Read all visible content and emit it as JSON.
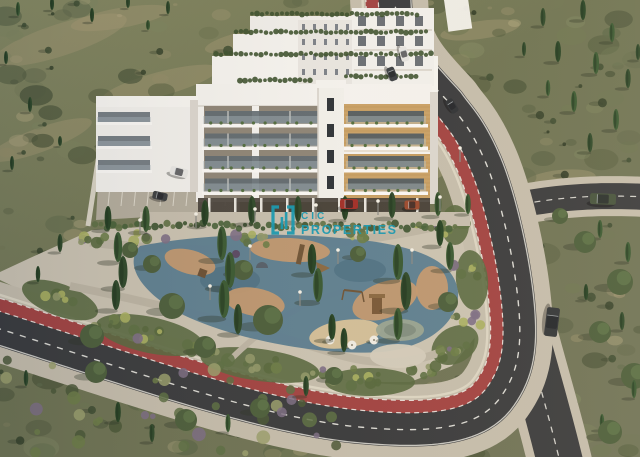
{
  "watermark": {
    "brand": "CIC",
    "brand_suffix": "PROPERTIES",
    "color": "#1d9ab0"
  },
  "scene": {
    "colors": {
      "hill_base": "#6e7454",
      "hill_dark": "#4c563a",
      "hill_light": "#868a64",
      "dry_patch": "#ab9f79",
      "asphalt": "#3a3c3f",
      "bike_lane_red": "#a24444",
      "road_line_white": "#ecebe5",
      "sidewalk": "#c5beae",
      "curb": "#ded8c8",
      "park_ground": "#cbc4b4",
      "path_gray": "#bdb6a6",
      "playground_blue": "#5b7e92",
      "playground_blue_dark": "#4e7084",
      "playground_tan": "#c59a70",
      "sand": "#d8c29a",
      "building_white": "#f5f4f1",
      "building_shade": "#dcd8d1",
      "panel_gray": "#8e8679",
      "panel_wood": "#caa268",
      "wood_line": "#b08a52",
      "glass": "#5e6a72",
      "garage_dark": "#443f39",
      "cypress": "#2f4a2c",
      "olive": "#4c5f3d",
      "shrub_green": "#5d7045",
      "lavender": "#7d6f86",
      "equipment_wood": "#6f5539"
    },
    "cars": [
      {
        "name": "white-van-upper-road",
        "x": 404,
        "y": 54,
        "len": 15,
        "wid": 8,
        "rot": 75,
        "body": "#e6e6e4"
      },
      {
        "name": "dark-suv-upper-road",
        "x": 392,
        "y": 74,
        "len": 14,
        "wid": 8,
        "rot": 68,
        "body": "#3a3f44"
      },
      {
        "name": "dark-car-right-road",
        "x": 452,
        "y": 106,
        "len": 15,
        "wid": 8,
        "rot": 58,
        "body": "#2f3338"
      },
      {
        "name": "green-suv-side-road",
        "x": 603,
        "y": 199,
        "len": 26,
        "wid": 11,
        "rot": 2,
        "body": "#46543f"
      },
      {
        "name": "dark-sedan-lower-road",
        "x": 552,
        "y": 322,
        "len": 29,
        "wid": 13,
        "rot": 97,
        "body": "#33373b"
      },
      {
        "name": "red-car-garage",
        "x": 349,
        "y": 204,
        "len": 18,
        "wid": 10,
        "rot": 0,
        "body": "#a22f2a"
      },
      {
        "name": "orange-car-garage",
        "x": 412,
        "y": 205,
        "len": 15,
        "wid": 9,
        "rot": 0,
        "body": "#9c4a30"
      },
      {
        "name": "white-pickup-parking",
        "x": 179,
        "y": 172,
        "len": 18,
        "wid": 9,
        "rot": 14,
        "body": "#e9e9e7"
      },
      {
        "name": "dark-car-parking",
        "x": 160,
        "y": 196,
        "len": 15,
        "wid": 8,
        "rot": 12,
        "body": "#3c4043"
      }
    ],
    "cypresses": [
      [
        18,
        16,
        14
      ],
      [
        52,
        10,
        13
      ],
      [
        92,
        22,
        14
      ],
      [
        128,
        8,
        12
      ],
      [
        168,
        14,
        13
      ],
      [
        6,
        64,
        13
      ],
      [
        30,
        112,
        15
      ],
      [
        12,
        170,
        14
      ],
      [
        60,
        146,
        10
      ],
      [
        148,
        30,
        10
      ],
      [
        543,
        26,
        18
      ],
      [
        583,
        20,
        20
      ],
      [
        612,
        42,
        19
      ],
      [
        558,
        62,
        21
      ],
      [
        596,
        74,
        22
      ],
      [
        628,
        88,
        19
      ],
      [
        574,
        112,
        21
      ],
      [
        616,
        130,
        21
      ],
      [
        590,
        152,
        19
      ],
      [
        548,
        96,
        16
      ],
      [
        638,
        60,
        16
      ],
      [
        524,
        56,
        14
      ],
      [
        600,
        238,
        18
      ],
      [
        628,
        262,
        20
      ],
      [
        586,
        300,
        16
      ],
      [
        622,
        330,
        18
      ],
      [
        634,
        398,
        18
      ],
      [
        602,
        430,
        16
      ],
      [
        108,
        230,
        24
      ],
      [
        146,
        232,
        26
      ],
      [
        205,
        226,
        26
      ],
      [
        252,
        224,
        28
      ],
      [
        298,
        222,
        26
      ],
      [
        345,
        220,
        24
      ],
      [
        392,
        218,
        26
      ],
      [
        438,
        216,
        24
      ],
      [
        468,
        214,
        20
      ],
      [
        118,
        262,
        30
      ],
      [
        123,
        288,
        32
      ],
      [
        116,
        310,
        30
      ],
      [
        222,
        260,
        34
      ],
      [
        230,
        288,
        36
      ],
      [
        224,
        318,
        38
      ],
      [
        238,
        334,
        30
      ],
      [
        312,
        274,
        30
      ],
      [
        318,
        302,
        34
      ],
      [
        398,
        280,
        36
      ],
      [
        406,
        310,
        38
      ],
      [
        398,
        340,
        32
      ],
      [
        440,
        246,
        26
      ],
      [
        450,
        270,
        28
      ],
      [
        332,
        340,
        26
      ],
      [
        344,
        352,
        24
      ],
      [
        60,
        252,
        18
      ],
      [
        38,
        282,
        16
      ],
      [
        26,
        386,
        16
      ],
      [
        118,
        422,
        20
      ],
      [
        152,
        442,
        18
      ],
      [
        228,
        432,
        18
      ],
      [
        306,
        396,
        20
      ]
    ],
    "olives": [
      [
        172,
        306,
        13
      ],
      [
        268,
        320,
        15
      ],
      [
        152,
        264,
        9
      ],
      [
        243,
        270,
        10
      ],
      [
        358,
        254,
        8
      ],
      [
        448,
        302,
        10
      ],
      [
        92,
        336,
        12
      ],
      [
        205,
        347,
        11
      ],
      [
        585,
        242,
        11
      ],
      [
        620,
        282,
        13
      ],
      [
        600,
        332,
        11
      ],
      [
        634,
        376,
        13
      ],
      [
        610,
        432,
        12
      ],
      [
        560,
        216,
        8
      ],
      [
        130,
        250,
        8
      ],
      [
        96,
        372,
        11
      ],
      [
        186,
        420,
        11
      ],
      [
        260,
        408,
        10
      ],
      [
        334,
        376,
        9
      ]
    ],
    "lamps": [
      [
        140,
        234
      ],
      [
        196,
        228
      ],
      [
        255,
        223
      ],
      [
        316,
        219
      ],
      [
        378,
        215
      ],
      [
        440,
        211
      ],
      [
        250,
        260
      ],
      [
        338,
        264
      ],
      [
        412,
        264
      ],
      [
        210,
        300
      ],
      [
        300,
        306
      ],
      [
        460,
        162
      ]
    ],
    "umbrellas": [
      [
        330,
        340
      ],
      [
        352,
        345
      ],
      [
        374,
        340
      ]
    ]
  }
}
